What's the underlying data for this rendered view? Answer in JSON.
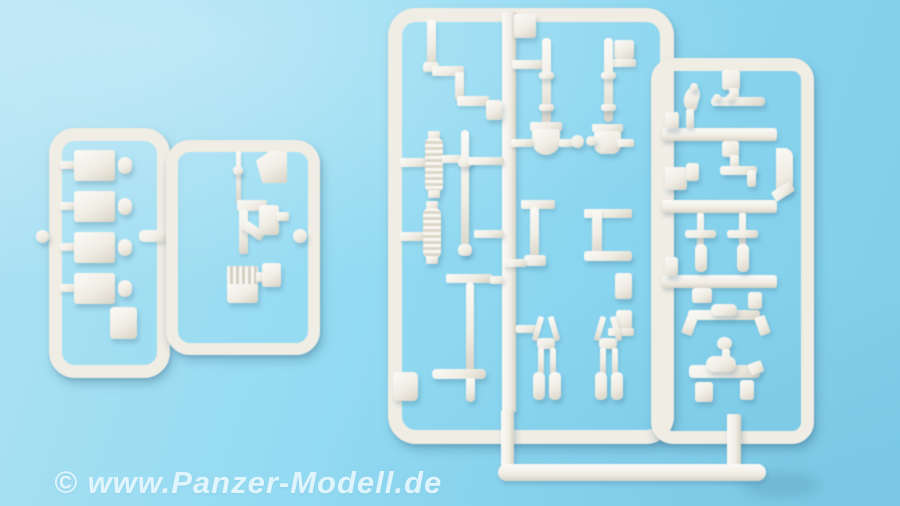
{
  "scene": {
    "type": "photograph",
    "subject": "Four light-grey injection-moulded plastic model kit sprues (runners) with small tank accessory parts, photographed on a light blue surface"
  },
  "watermark": {
    "text": "© www.Panzer-Modell.de"
  },
  "colors": {
    "bg1": "#b0e2f3",
    "bg2": "#95dbf2",
    "bg3": "#7fcde9",
    "plastic": "#f0ede4",
    "plasticHi": "#fbfaf6",
    "plasticLo": "#d8d3c6",
    "watermark": "#f2fbff"
  },
  "sprues": [
    {
      "id": "A",
      "description": "small sprue with four rectangular stowage boxes, four round knobs and one small box"
    },
    {
      "id": "B",
      "description": "small sprue with corner wedge, thin antenna rod, angled bracket and louvred grille"
    },
    {
      "id": "C",
      "description": "large sprue with stepped bracket, two ribbed rollers, rods, shovel, spade, long pole with crossbar and two tow-clevis pairs"
    },
    {
      "id": "D",
      "description": "tall ladder sprue with hook, tie rod, T-fitting, two periscope posts, axle with bent ends and exhaust part"
    }
  ]
}
